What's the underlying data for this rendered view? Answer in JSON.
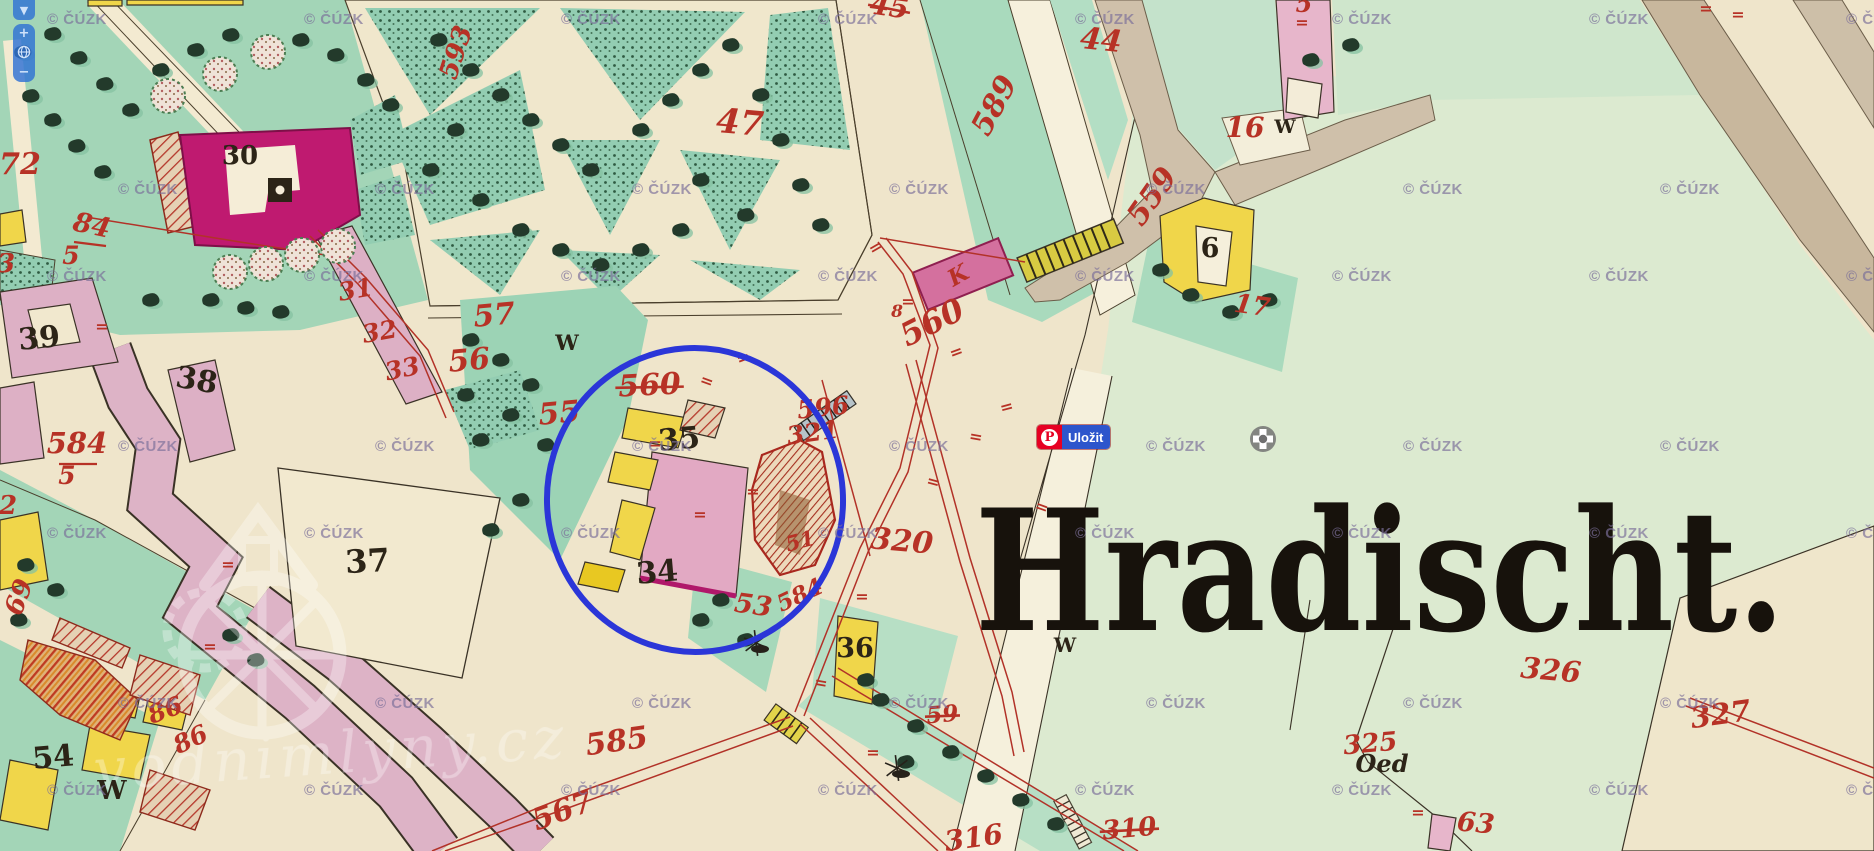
{
  "ui": {
    "map_control": {
      "pan_down": "▼",
      "zoom_in": "+",
      "zoom_out": "−",
      "globe": "globe-icon"
    },
    "pinterest_button": {
      "label": "Uložit",
      "icon_letter": "P",
      "brand_color": "#e60023",
      "label_bg": "#2d55cc"
    },
    "crosshair_icon": {
      "name": "crosshair-marker",
      "color": "#6f6f6f"
    }
  },
  "watermark": {
    "text": "© ČÚZK",
    "step": 257,
    "rows": [
      {
        "y": 20,
        "off": 47
      },
      {
        "y": 190,
        "off": 118
      },
      {
        "y": 277,
        "off": 47
      },
      {
        "y": 447,
        "off": 118
      },
      {
        "y": 534,
        "off": 47
      },
      {
        "y": 704,
        "off": 118
      },
      {
        "y": 791,
        "off": 47
      }
    ]
  },
  "brand_watermark": {
    "text": "vodnimlyny.cz"
  },
  "annotation": {
    "type": "ellipse",
    "cx": 695,
    "cy": 500,
    "rx": 148,
    "ry": 152,
    "rot": -4,
    "color": "#2b36d8",
    "width": 6
  },
  "big_label": {
    "text": "Hradischt.",
    "x": 975,
    "y": 630,
    "size": 168,
    "length": 810,
    "color": "#17120c"
  },
  "colors": {
    "red": "#b73226",
    "black": "#2c2417"
  },
  "labels_red": [
    {
      "t": "593",
      "x": 464,
      "y": 55,
      "s": 26,
      "r": -72
    },
    {
      "t": "45",
      "x": 888,
      "y": 16,
      "s": 28,
      "r": 8,
      "strike": 1
    },
    {
      "t": "47",
      "x": 739,
      "y": 134,
      "s": 34,
      "r": 5
    },
    {
      "t": "44",
      "x": 1100,
      "y": 50,
      "s": 30,
      "r": 6
    },
    {
      "t": "589",
      "x": 1003,
      "y": 110,
      "s": 30,
      "r": -62
    },
    {
      "t": "5",
      "x": 1304,
      "y": 12,
      "s": 24,
      "r": 0
    },
    {
      "t": "16",
      "x": 1245,
      "y": 137,
      "s": 28,
      "r": 0
    },
    {
      "t": "559",
      "x": 1160,
      "y": 202,
      "s": 30,
      "r": -55
    },
    {
      "t": "17",
      "x": 1251,
      "y": 314,
      "s": 26,
      "r": 8
    },
    {
      "t": "560",
      "x": 650,
      "y": 395,
      "s": 30,
      "r": -3,
      "strike": 1
    },
    {
      "t": "560",
      "x": 937,
      "y": 332,
      "s": 32,
      "r": -27
    },
    {
      "t": "8",
      "x": 897,
      "y": 317,
      "s": 17,
      "r": 0
    },
    {
      "t": "596",
      "x": 824,
      "y": 416,
      "s": 25,
      "r": -6
    },
    {
      "t": "321",
      "x": 814,
      "y": 441,
      "s": 25,
      "r": -8
    },
    {
      "t": "320",
      "x": 901,
      "y": 551,
      "s": 30,
      "r": 5
    },
    {
      "t": "51",
      "x": 802,
      "y": 548,
      "s": 21,
      "r": -15
    },
    {
      "t": "584",
      "x": 803,
      "y": 602,
      "s": 23,
      "r": -25
    },
    {
      "t": "53",
      "x": 752,
      "y": 614,
      "s": 27,
      "r": 8
    },
    {
      "t": "585",
      "x": 618,
      "y": 751,
      "s": 30,
      "r": -8
    },
    {
      "t": "567",
      "x": 566,
      "y": 820,
      "s": 30,
      "r": -20
    },
    {
      "t": "59",
      "x": 943,
      "y": 722,
      "s": 23,
      "r": -5,
      "strike": 1
    },
    {
      "t": "316",
      "x": 975,
      "y": 847,
      "s": 28,
      "r": -8
    },
    {
      "t": "310",
      "x": 1130,
      "y": 837,
      "s": 26,
      "r": -5,
      "strike": 1
    },
    {
      "t": "326",
      "x": 1550,
      "y": 680,
      "s": 29,
      "r": 5
    },
    {
      "t": "325",
      "x": 1371,
      "y": 752,
      "s": 26,
      "r": -5
    },
    {
      "t": "63",
      "x": 1475,
      "y": 832,
      "s": 27,
      "r": 5
    },
    {
      "t": "327",
      "x": 1722,
      "y": 724,
      "s": 29,
      "r": -8
    },
    {
      "t": "72",
      "x": 20,
      "y": 174,
      "s": 30,
      "r": 0
    },
    {
      "t": "84",
      "x": 90,
      "y": 234,
      "s": 27,
      "r": 12
    },
    {
      "t": "5",
      "x": 71,
      "y": 264,
      "s": 25,
      "r": 0
    },
    {
      "t": "584",
      "x": 77,
      "y": 453,
      "s": 29,
      "r": 0
    },
    {
      "t": "5",
      "x": 67,
      "y": 484,
      "s": 25,
      "r": 0
    },
    {
      "t": "3",
      "x": 6,
      "y": 272,
      "s": 26,
      "r": 0
    },
    {
      "t": "2",
      "x": 8,
      "y": 514,
      "s": 26,
      "r": 0
    },
    {
      "t": "69",
      "x": 27,
      "y": 600,
      "s": 26,
      "r": -70
    },
    {
      "t": "86",
      "x": 168,
      "y": 718,
      "s": 25,
      "r": -20
    },
    {
      "t": "86",
      "x": 194,
      "y": 747,
      "s": 25,
      "r": -25
    },
    {
      "t": "56",
      "x": 470,
      "y": 370,
      "s": 30,
      "r": -5
    },
    {
      "t": "57",
      "x": 495,
      "y": 325,
      "s": 30,
      "r": -5
    },
    {
      "t": "55",
      "x": 560,
      "y": 423,
      "s": 30,
      "r": -5
    },
    {
      "t": "31",
      "x": 357,
      "y": 298,
      "s": 25,
      "r": -10
    },
    {
      "t": "32",
      "x": 381,
      "y": 340,
      "s": 25,
      "r": -10
    },
    {
      "t": "33",
      "x": 404,
      "y": 377,
      "s": 25,
      "r": -12
    },
    {
      "t": "K",
      "x": 962,
      "y": 282,
      "s": 23,
      "r": -30
    }
  ],
  "labels_black": [
    {
      "t": "30",
      "x": 240,
      "y": 164,
      "s": 26
    },
    {
      "t": "38",
      "x": 195,
      "y": 390,
      "s": 30,
      "r": 10
    },
    {
      "t": "39",
      "x": 40,
      "y": 348,
      "s": 30,
      "r": -5
    },
    {
      "t": "37",
      "x": 368,
      "y": 572,
      "s": 32,
      "r": -3
    },
    {
      "t": "35",
      "x": 680,
      "y": 449,
      "s": 30,
      "r": -5
    },
    {
      "t": "34",
      "x": 658,
      "y": 582,
      "s": 30,
      "r": -5
    },
    {
      "t": "54",
      "x": 54,
      "y": 767,
      "s": 30,
      "r": -5
    },
    {
      "t": "36",
      "x": 855,
      "y": 657,
      "s": 27
    },
    {
      "t": "6",
      "x": 1210,
      "y": 257,
      "s": 27
    },
    {
      "t": "W",
      "x": 567,
      "y": 350,
      "s": 21
    },
    {
      "t": "W",
      "x": 1285,
      "y": 133,
      "s": 19
    },
    {
      "t": "W",
      "x": 112,
      "y": 799,
      "s": 26
    },
    {
      "t": "W",
      "x": 1065,
      "y": 652,
      "s": 20
    },
    {
      "t": "Oed",
      "x": 1382,
      "y": 772,
      "s": 24,
      "i": 1
    }
  ],
  "ticks": [
    [
      705,
      386,
      20
    ],
    [
      878,
      252,
      -30
    ],
    [
      932,
      487,
      15
    ],
    [
      975,
      442,
      10
    ],
    [
      1040,
      512,
      20
    ],
    [
      862,
      602,
      0
    ],
    [
      820,
      688,
      10
    ],
    [
      228,
      570,
      0
    ],
    [
      102,
      332,
      0
    ],
    [
      210,
      652,
      0
    ],
    [
      1418,
      818,
      0
    ],
    [
      1706,
      14,
      0
    ],
    [
      1738,
      20,
      0
    ],
    [
      655,
      449,
      0
    ],
    [
      700,
      520,
      0
    ],
    [
      745,
      363,
      -20
    ],
    [
      908,
      307,
      0
    ],
    [
      958,
      357,
      -20
    ],
    [
      1008,
      412,
      -15
    ],
    [
      873,
      758,
      0
    ],
    [
      753,
      497,
      0
    ],
    [
      1302,
      28,
      0
    ]
  ],
  "frac_bars": [
    [
      74,
      242,
      106,
      246
    ],
    [
      59,
      464,
      97,
      464
    ]
  ],
  "bushes": [
    [
      897,
      768
    ],
    [
      756,
      643
    ]
  ]
}
